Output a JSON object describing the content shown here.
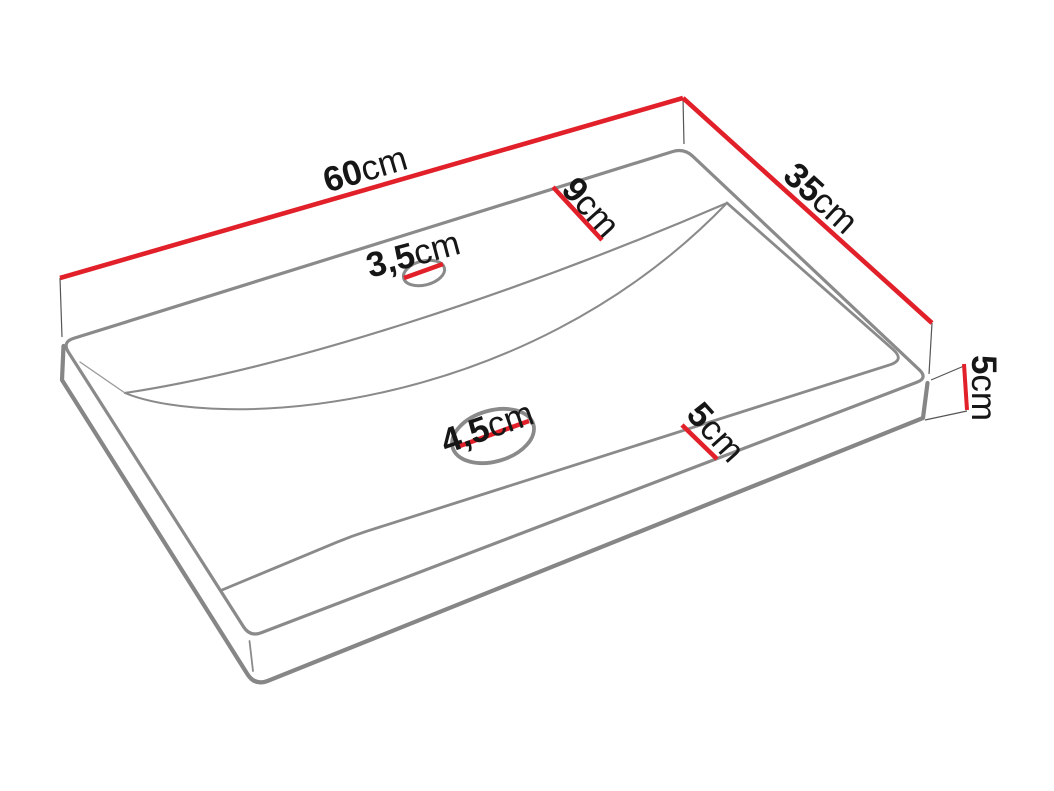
{
  "diagram": {
    "title": "Washbasin technical dimension drawing",
    "object": "countertop-washbasin",
    "colors": {
      "dimension_line": "#e1202a",
      "outline": "#8a8a8a",
      "extension_line": "#555555",
      "text": "#161616",
      "background": "#ffffff"
    },
    "labels": {
      "width": {
        "value": "60",
        "unit": "cm"
      },
      "depth": {
        "value": "35",
        "unit": "cm"
      },
      "back_rim": {
        "value": "9",
        "unit": "cm"
      },
      "faucet_hole": {
        "value": "3,5",
        "unit": "cm"
      },
      "drain_hole": {
        "value": "4,5",
        "unit": "cm"
      },
      "front_rim": {
        "value": "5",
        "unit": "cm"
      },
      "height": {
        "value": "5",
        "unit": "cm"
      }
    }
  }
}
